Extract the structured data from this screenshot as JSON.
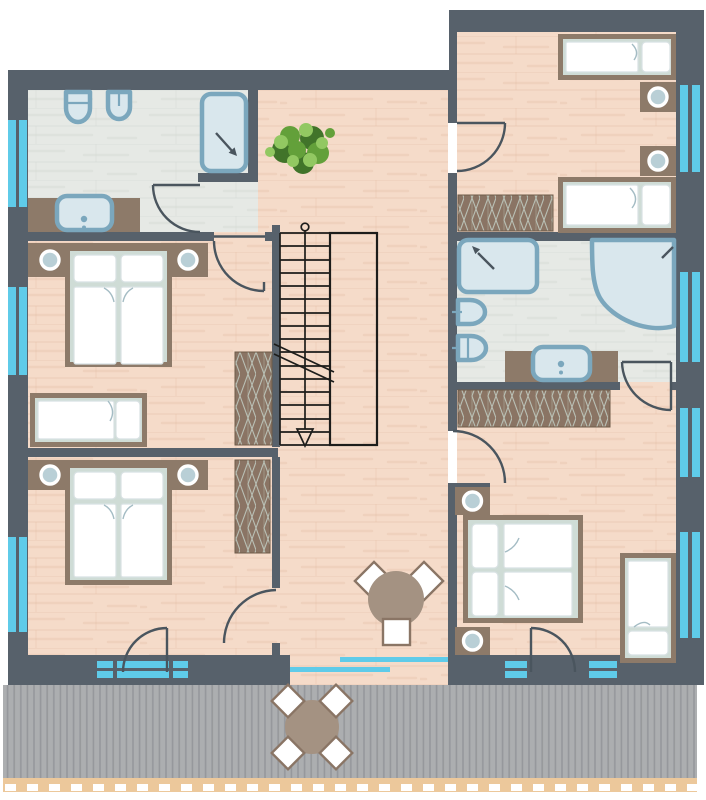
{
  "canvas": {
    "width": 706,
    "height": 800
  },
  "palette": {
    "background": "#ffffff",
    "wall": "#57616b",
    "wood_floor": "#f5dbc9",
    "wood_grain": "#e3bda5",
    "bath_floor": "#e6e9e5",
    "bath_grain": "#d2d8d2",
    "window_glass": "#5fcbe9",
    "furniture": "#8d7a69",
    "wardrobe": "#8a7464",
    "wardrobe_hatch": "#b9bfb4",
    "wardrobe_line": "#6e5b49",
    "bed_inner": "#cfdcd6",
    "textile": "#ffffff",
    "textile_stroke": "#d8e1e3",
    "fold_stroke": "#a4bcc4",
    "fixture_fill": "#d9e7ed",
    "fixture_stroke": "#7ba7bd",
    "lamp_center": "#b9cfd6",
    "door_line": "#4a555e",
    "stair_line": "#1d1d1b",
    "deck": "#acaeb0",
    "deck_stripe": "#96989b",
    "railing": "#ecc89b",
    "table": "#a49282",
    "chair_stroke": "#8a7565",
    "plant_dark": "#41742a",
    "plant_mid": "#63a03a",
    "plant_light": "#92c862"
  },
  "scene": {
    "type": "architectural floor plan, upper storey",
    "rooms": [
      {
        "name": "bathroom-top-left",
        "fixtures": [
          "toilet",
          "bidet",
          "shower",
          "sink-vanity"
        ],
        "windows": 1,
        "doors": 1
      },
      {
        "name": "bedroom-middle-left",
        "furniture": [
          "double-bed",
          "single-bed",
          "wardrobe",
          "two-nightstand-lamps"
        ],
        "windows": 1,
        "doors": 1
      },
      {
        "name": "bedroom-bottom-left",
        "furniture": [
          "double-bed",
          "wardrobe",
          "two-nightstand-lamps"
        ],
        "windows": 2,
        "doors": 2
      },
      {
        "name": "bedroom-top-right",
        "furniture": [
          "single-bed",
          "single-bed",
          "wardrobe",
          "two-nightstand-lamps"
        ],
        "windows": 1,
        "doors": 1
      },
      {
        "name": "bathroom-right",
        "fixtures": [
          "shower",
          "corner-bathtub",
          "toilet",
          "bidet",
          "sink-vanity",
          "wardrobe"
        ],
        "windows": 1,
        "doors": 1
      },
      {
        "name": "bedroom-bottom-right",
        "furniture": [
          "double-bed",
          "single-bed",
          "two-nightstand-lamps"
        ],
        "windows": 3,
        "doors": 2
      },
      {
        "name": "hallway",
        "features": [
          "staircase",
          "potted-plant",
          "round-table-with-3-chairs",
          "sliding-glass-front"
        ]
      },
      {
        "name": "terrace",
        "features": [
          "round-table-with-4-chairs",
          "slatted-deck",
          "railing"
        ]
      }
    ],
    "staircase": {
      "treads": 16,
      "direction": "arrow-down",
      "break_line": true
    }
  }
}
